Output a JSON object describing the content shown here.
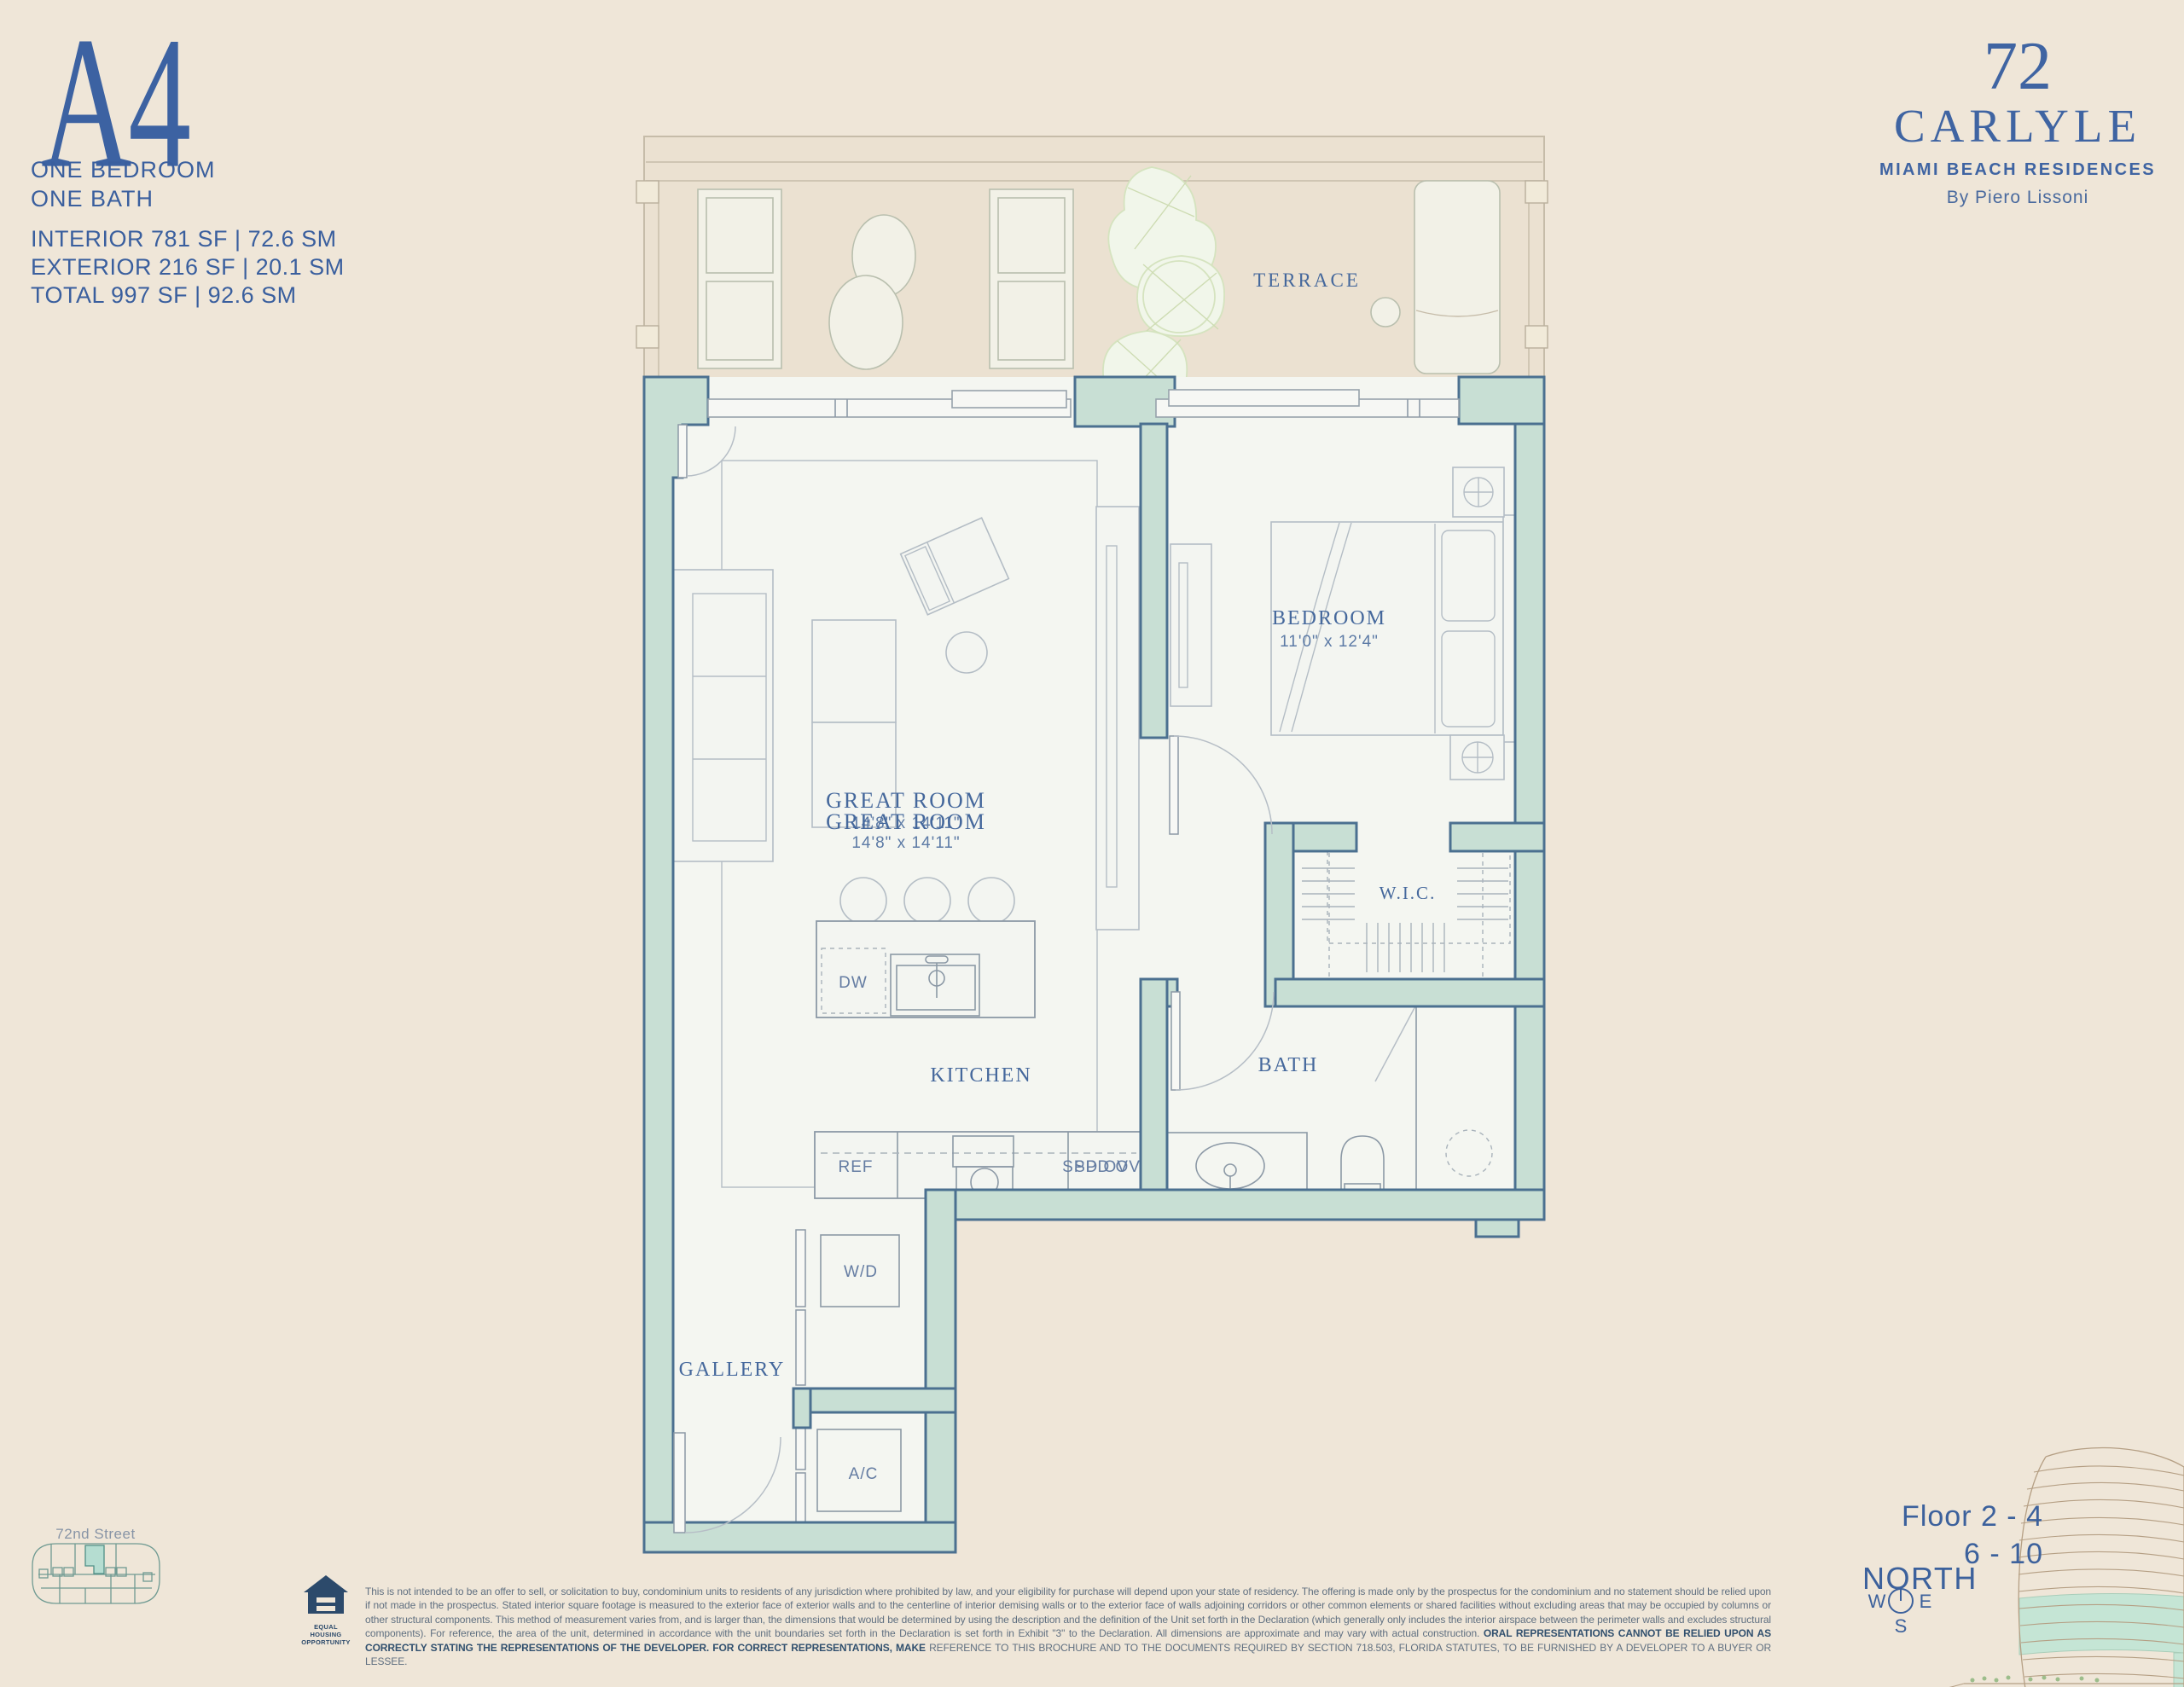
{
  "unit": {
    "id": "A4",
    "type_lines": [
      "ONE BEDROOM",
      "ONE BATH"
    ],
    "stats": [
      "INTERIOR 781 SF | 72.6 SM",
      "EXTERIOR 216 SF | 20.1 SM",
      "TOTAL 997 SF | 92.6 SM"
    ]
  },
  "brand": {
    "number": "72",
    "name": "CARLYLE",
    "tagline": "MIAMI BEACH RESIDENCES",
    "byline": "By Piero Lissoni"
  },
  "plan": {
    "labels": {
      "terrace": "TERRACE",
      "great_room": "GREAT ROOM",
      "great_room_dims": "14'8\" x 14'11\"",
      "bedroom": "BEDROOM",
      "bedroom_dims": "11'0\" x 12'4\"",
      "kitchen": "KITCHEN",
      "bath": "BATH",
      "wic": "W.I.C.",
      "gallery": "GALLERY",
      "wd": "W/D",
      "ac": "A/C",
      "dw": "DW",
      "ref": "REF",
      "spd_ov": "SPD OV"
    }
  },
  "keyplan": {
    "street": "72nd Street"
  },
  "location": {
    "floors_line1": "Floor 2 - 4",
    "floors_line2": "6 - 10",
    "north": "NORTH",
    "west": "W",
    "east": "E",
    "south": "S"
  },
  "footer": {
    "eho_line1": "EQUAL HOUSING",
    "eho_line2": "OPPORTUNITY",
    "disclaimer_text": "This is not intended to be an offer to sell, or solicitation to buy, condominium units to residents of any jurisdiction where prohibited by law, and your eligibility for purchase will depend upon your state of residency. The offering is made only by the prospectus for the condominium and no statement should be relied upon if not made in the prospectus. Stated interior square footage is measured to the exterior face of exterior walls and to the centerline of interior demising walls or to the exterior face of walls adjoining corridors or other common elements or shared facilities without excluding areas that may be occupied by columns or other structural components. This method of measurement varies from, and is larger than, the dimensions that would be determined by using the description and the definition of the Unit set forth in the Declaration (which generally only includes the interior airspace between the perimeter walls and excludes structural components). For reference, the area of the unit, determined in accordance with the unit boundaries set forth in the Declaration is set forth in Exhibit \"3\" to the Declaration. All dimensions are approximate and may vary with actual construction.",
    "disclaimer_bold": "ORAL REPRESENTATIONS CANNOT BE RELIED UPON AS CORRECTLY STATING THE REPRESENTATIONS OF THE DEVELOPER. FOR CORRECT REPRESENTATIONS, MAKE",
    "disclaimer_end": "REFERENCE TO THIS BROCHURE AND TO THE DOCUMENTS REQUIRED BY SECTION 718.503, FLORIDA STATUTES, TO BE FURNISHED BY A DEVELOPER TO A BUYER OR LESSEE."
  }
}
